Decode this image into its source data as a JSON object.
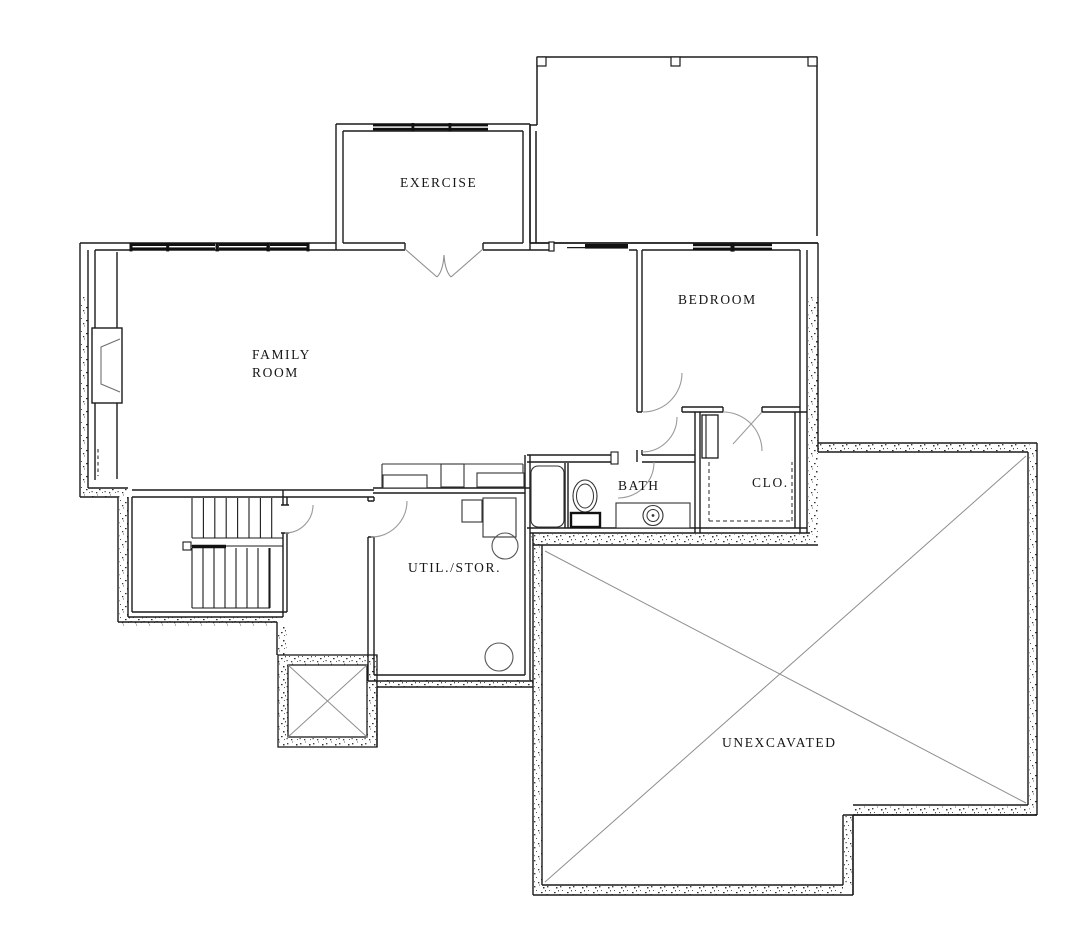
{
  "canvas": {
    "background": "#ffffff",
    "wall_color": "#1b1b1b",
    "fixture_color": "#333333",
    "arc_color": "#9a9a9a",
    "brace_color": "#8f8f8f",
    "text_color": "#161616"
  },
  "plan_type": "basement floor plan",
  "labels": {
    "exercise": "EXERCISE",
    "family_line1": "FAMILY",
    "family_line2": "ROOM",
    "bedroom": "BEDROOM",
    "bath": "BATH",
    "closet": "CLO.",
    "util_stor": "UTIL./STOR.",
    "unexcavated": "UNEXCAVATED"
  },
  "features": {
    "stairs": "switchback stair with center handrail",
    "window_well": "window well with x-brace",
    "unexcavated_brace": "x-braced unexcavated crawl area",
    "deck": "open deck/patio outline with posts",
    "fireplace": "fireplace alcove on family room west wall",
    "fixtures": [
      "bathtub",
      "toilet",
      "vanity-sink",
      "water-heater",
      "furnace",
      "built-in-cabinets"
    ],
    "openings": [
      "french-doors-exercise",
      "sliding-door-family",
      "windows-family",
      "windows-exercise",
      "window-bedroom",
      "swing-doors"
    ]
  }
}
